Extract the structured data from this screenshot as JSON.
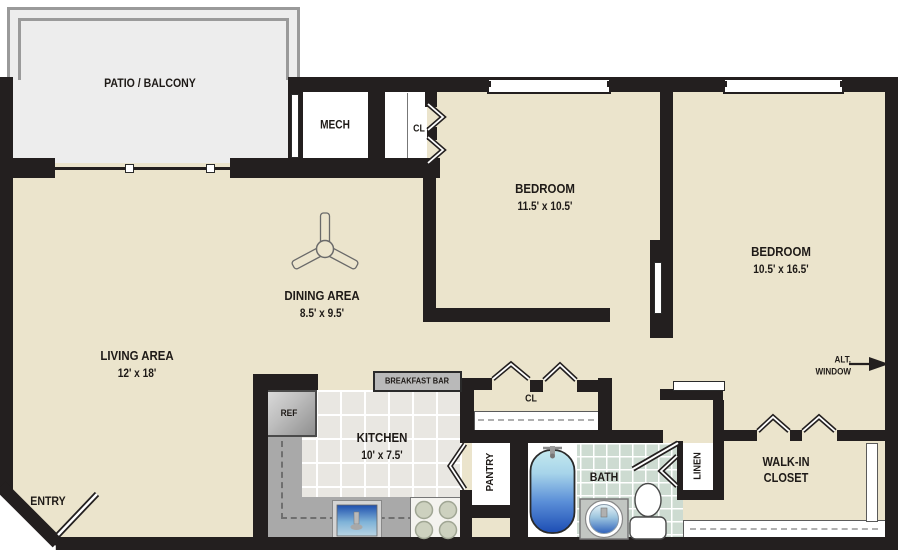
{
  "plan": {
    "patio": {
      "label": "PATIO / BALCONY"
    },
    "mech": {
      "label": "MECH"
    },
    "bedroom1_closet": {
      "label": "CL"
    },
    "bedroom1": {
      "label": "BEDROOM",
      "dims": "11.5' x 10.5'"
    },
    "bedroom2": {
      "label": "BEDROOM",
      "dims": "10.5' x 16.5'"
    },
    "dining": {
      "label": "DINING AREA",
      "dims": "8.5' x 9.5'"
    },
    "living": {
      "label": "LIVING AREA",
      "dims": "12' x 18'"
    },
    "kitchen": {
      "label": "KITCHEN",
      "dims": "10' x 7.5'"
    },
    "breakfast_bar": {
      "label": "BREAKFAST BAR"
    },
    "refrigerator": {
      "label": "REF"
    },
    "hall_closet": {
      "label": "CL"
    },
    "pantry": {
      "label": "PANTRY"
    },
    "bath": {
      "label": "BATH"
    },
    "linen": {
      "label": "LINEN"
    },
    "walk_in_closet": {
      "line1": "WALK-IN",
      "line2": "CLOSET"
    },
    "alt_window": {
      "line1": "ALT.",
      "line2": "WINDOW"
    },
    "entry": {
      "label": "ENTRY"
    }
  },
  "colors": {
    "wall": "#231f1f",
    "floor": "#ebe4cc",
    "patio": "#ededed",
    "kitchen_tile": "#e9e7e2",
    "bath_tile": "#cddbd1",
    "counter": "#a9a9a9",
    "tub_blue": "#1c4db4"
  }
}
